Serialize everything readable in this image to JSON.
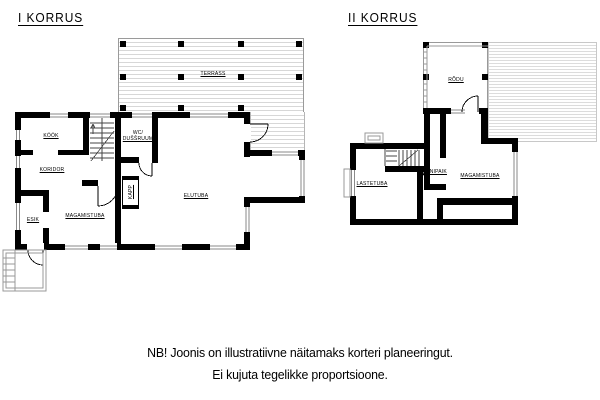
{
  "page": {
    "background": "#ffffff"
  },
  "floor1": {
    "title": "I KORRUS",
    "rooms": {
      "terrass": "TERRASS",
      "kook": "KÖÖK",
      "koridor": "KORIDOR",
      "esik": "ESIK",
      "magamistuba": "MAGAMISTUBA",
      "wc_line1": "WC/",
      "wc_line2": "DUŠŠRUUM",
      "elutuba": "ELUTUBA",
      "kapp": "KAPP"
    }
  },
  "floor2": {
    "title": "II KORRUS",
    "rooms": {
      "rodu": "RÕDU",
      "lastetuba": "LASTETUBA",
      "panipaik": "PANIPAIK",
      "magamistuba": "MAGAMISTUBA"
    }
  },
  "note": {
    "line1": "NB! Joonis on illustratiivne näitamaks korteri planeeringut.",
    "line2": "Ei kujuta tegelikke proportsioone."
  },
  "colors": {
    "wall": "#000000",
    "deck_line": "#d7d7d7",
    "roof_line": "#dcdcdc",
    "window_line": "#8a8a8a",
    "thin_line": "#444444"
  }
}
